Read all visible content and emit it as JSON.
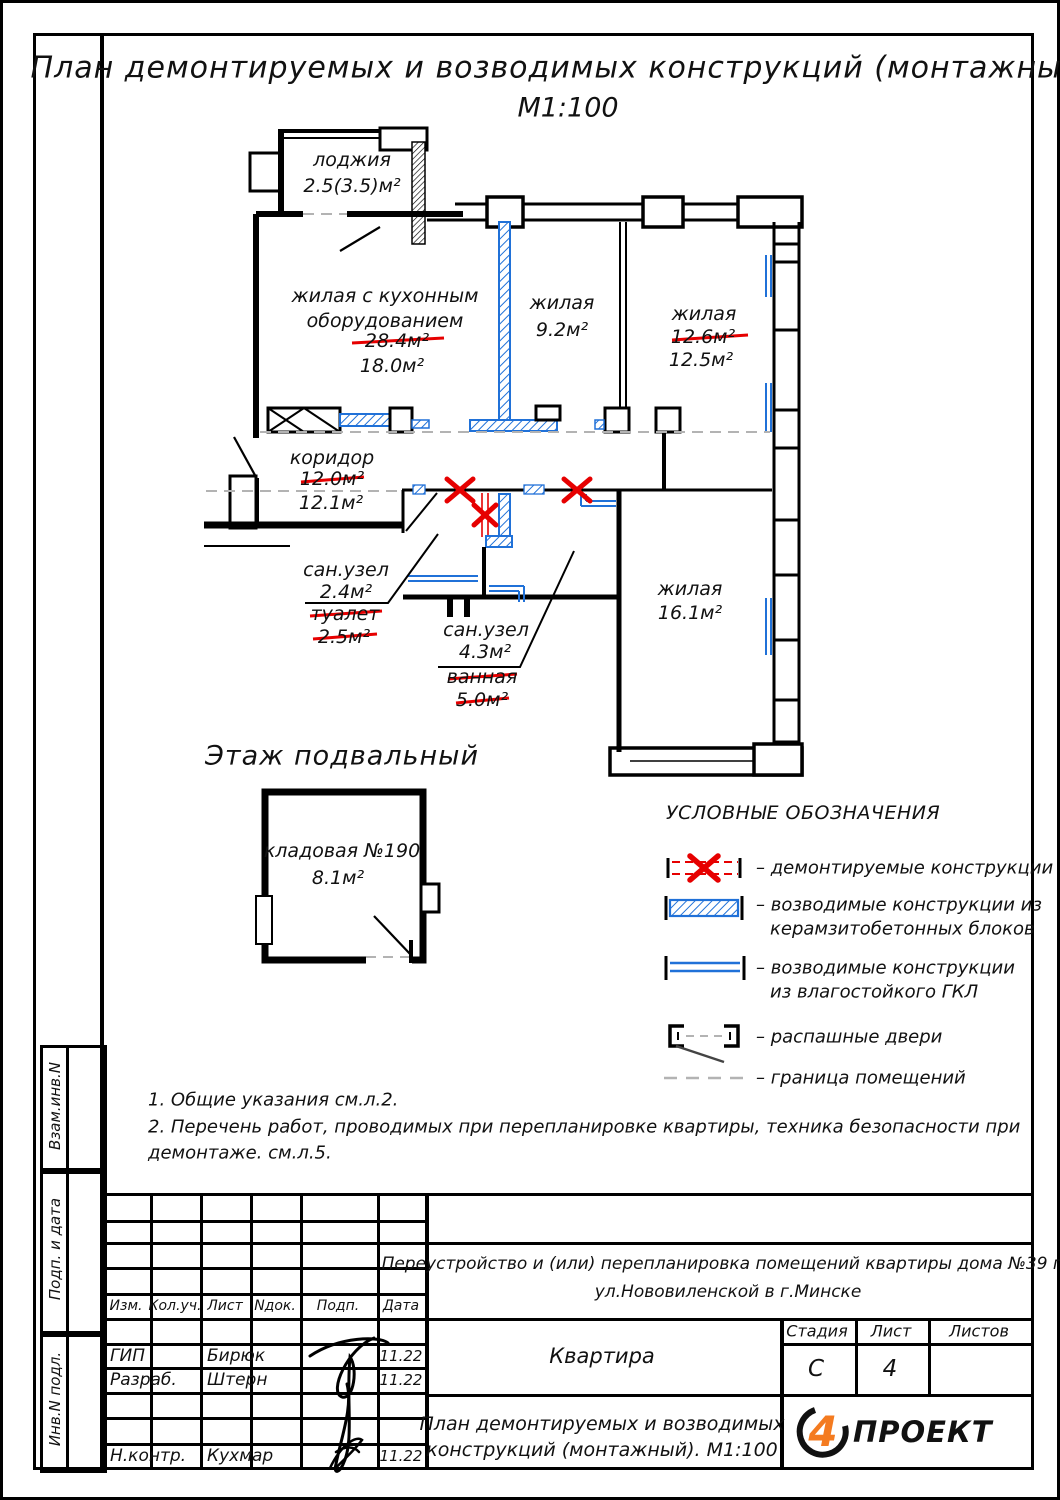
{
  "title": {
    "line1": "План демонтируемых и возводимых конструкций (монтажный).",
    "line2": "М1:100"
  },
  "plan": {
    "rooms": {
      "loggia": {
        "name": "лоджия",
        "area": "2.5(3.5)м²"
      },
      "living_kitchen": {
        "name_line1": "жилая с кухонным",
        "name_line2": "оборудованием",
        "area_old": "28.4м²",
        "area_new": "18.0м²"
      },
      "living_9": {
        "name": "жилая",
        "area": "9.2м²"
      },
      "living_12": {
        "name": "жилая",
        "area_old": "12.6м²",
        "area_new": "12.5м²"
      },
      "corridor": {
        "name": "коридор",
        "area_old": "12.0м²",
        "area_new": "12.1м²"
      },
      "bath_small": {
        "name": "сан.узел",
        "area": "2.4м²",
        "old_name": "туалет",
        "old_area": "2.5м²"
      },
      "bath_big": {
        "name": "сан.узел",
        "area": "4.3м²",
        "old_name": "ванная",
        "old_area": "5.0м²"
      },
      "living_16": {
        "name": "жилая",
        "area": "16.1м²"
      }
    },
    "basement": {
      "title": "Этаж подвальный",
      "room_name": "кладовая №190",
      "room_area": "8.1м²"
    }
  },
  "legend": {
    "title": "УСЛОВНЫЕ ОБОЗНАЧЕНИЯ",
    "items": [
      {
        "line1": "– демонтируемые конструкции"
      },
      {
        "line1": "– возводимые конструкции из",
        "line2": "керамзитобетонных блоков"
      },
      {
        "line1": "– возводимые конструкции",
        "line2": "из влагостойкого ГКЛ"
      },
      {
        "line1": "– распашные двери"
      },
      {
        "line1": "– граница помещений"
      }
    ]
  },
  "notes": {
    "line1": "1. Общие указания см.л.2.",
    "line2": "2. Перечень работ, проводимых при перепланировке квартиры, техника безопасности при",
    "line3": "демонтаже. см.л.5."
  },
  "stamp": {
    "header_cols": [
      "Изм.",
      "Кол.уч.",
      "Лист",
      "Nдок.",
      "Подп.",
      "Дата"
    ],
    "rows": [
      {
        "role": "ГИП",
        "name": "Бирюк",
        "date": "11.22"
      },
      {
        "role": "Разраб.",
        "name": "Штерн",
        "date": "11.22"
      },
      {
        "role": "Н.контр.",
        "name": "Кухмар",
        "date": "11.22"
      }
    ],
    "project_line1": "Переустройство и (или) перепланировка помещений квартиры дома №39 по",
    "project_line2": "ул.Нововиленской в г.Минске",
    "object_name": "Квартира",
    "stage_label": "Стадия",
    "sheet_label": "Лист",
    "sheets_label": "Листов",
    "stage": "С",
    "sheet": "4",
    "sheets": "",
    "doc_title_line1": "План демонтируемых и возводимых",
    "doc_title_line2": "конструкций (монтажный). М1:100",
    "logo_mark": "4",
    "logo_text": "ПРОЕКТ"
  },
  "side_labels": {
    "a": "Взам.инв.N",
    "b": "Подп. и дата",
    "c": "Инв.N подл."
  },
  "colors": {
    "demolition_red": "#e60000",
    "construction_blue": "#2071d8",
    "logo_orange": "#f47b20",
    "boundary_gray": "#b3b3b3"
  }
}
